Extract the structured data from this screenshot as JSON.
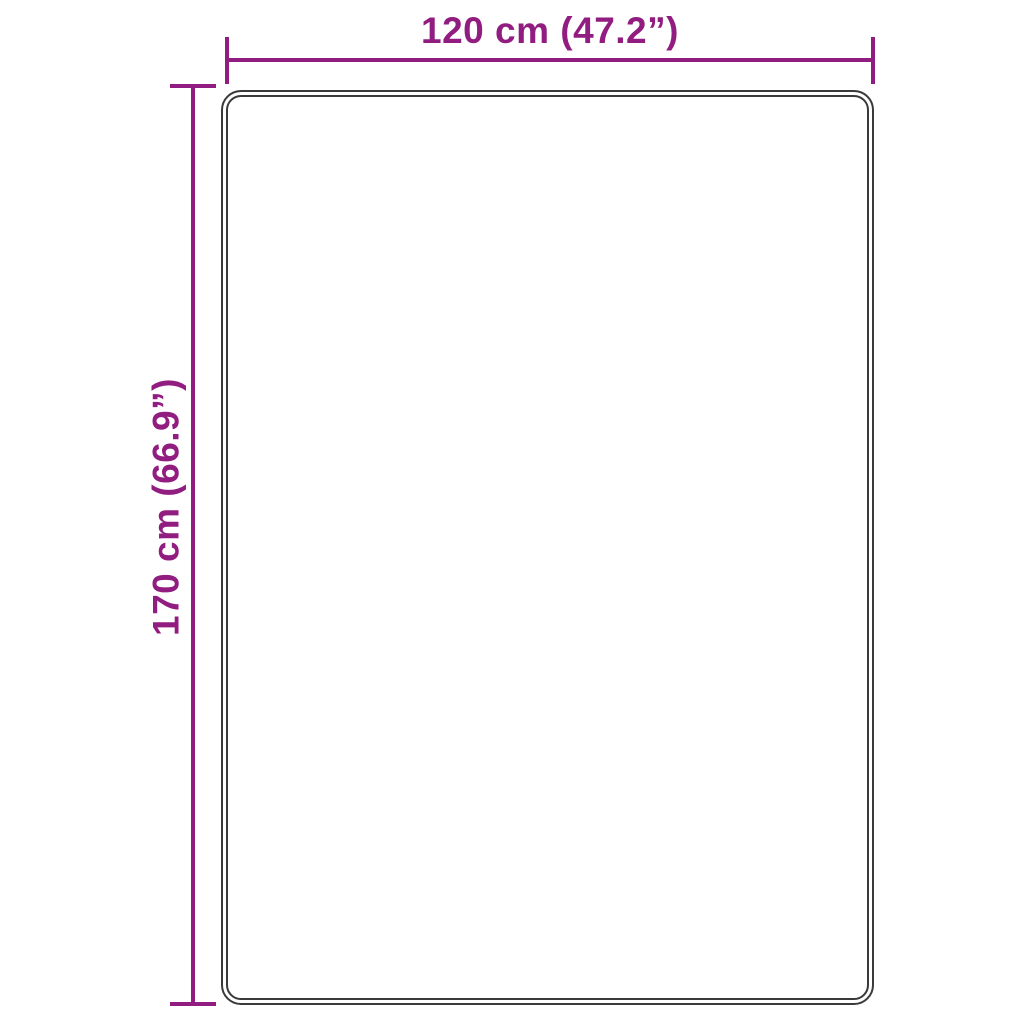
{
  "diagram": {
    "background_color": "#ffffff",
    "accent_color": "#911d80",
    "outline_color": "#3a3a3a",
    "width_dimension": {
      "label": "120 cm (47.2”)",
      "value_cm": 120,
      "value_inches": 47.2
    },
    "height_dimension": {
      "label": "170 cm (66.9”)",
      "value_cm": 170,
      "value_inches": 66.9
    }
  }
}
